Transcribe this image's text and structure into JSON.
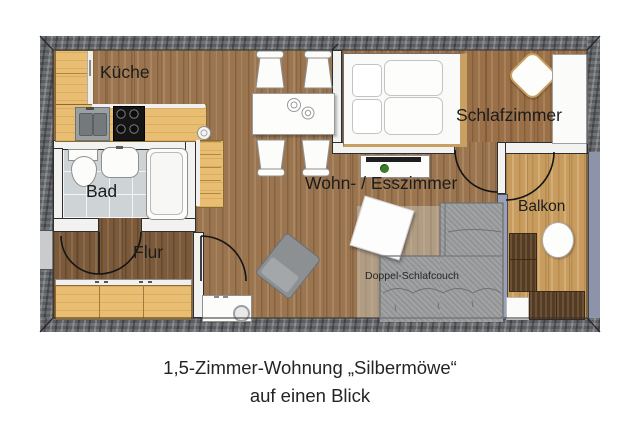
{
  "plan": {
    "rooms": {
      "kueche": "Küche",
      "bad": "Bad",
      "flur": "Flur",
      "wohn_esszimmer": "Wohn- / Esszimmer",
      "schlafzimmer": "Schlafzimmer",
      "balkon": "Balkon"
    },
    "furniture_labels": {
      "schlafcouch": "Doppel-Schlafcouch"
    },
    "colors": {
      "outer_wall": "#64676b",
      "living_floor": "#9a7550",
      "bedroom_floor": "#9a7049",
      "hall_floor": "#7b5a3b",
      "balcony_floor": "#c89c5e",
      "bath_floor": "#ced3d5",
      "cabinet_wood": "#e9bd72",
      "glass_partition": "#9aa0b5",
      "balcony_railing": "#8d93a8",
      "sofa_gray": "#9b9d9f",
      "balcony_chair_brown": "#5d4227",
      "bed_trim_gold": "#c9a063"
    }
  },
  "caption": {
    "line1": "1,5-Zimmer-Wohnung „Silbermöwe“",
    "line2": "auf einen Blick"
  }
}
